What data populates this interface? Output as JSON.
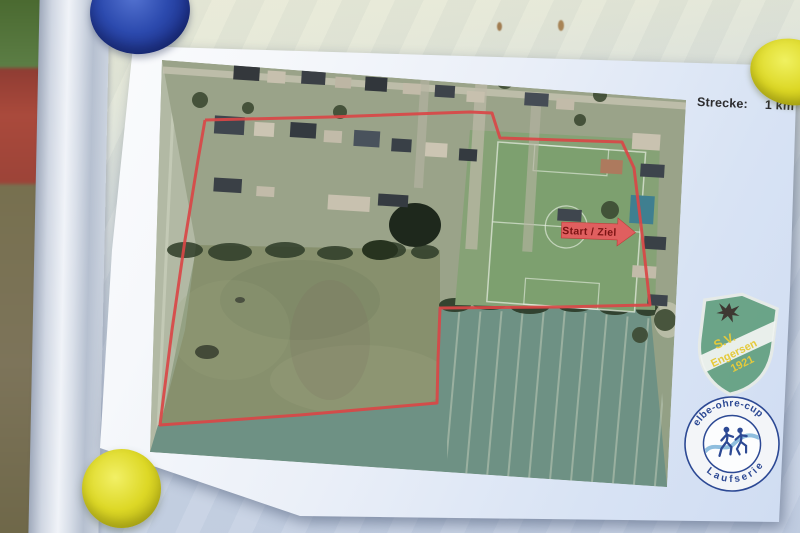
{
  "scene": {
    "distance_label": "Strecke:",
    "distance_value": "1 km",
    "start_finish_label": "Start / Ziel"
  },
  "logos": {
    "club_shield": {
      "abbr": "S.V.",
      "name": "Engersen",
      "year": "1921"
    },
    "cup_badge": {
      "arc_top": "elbe-ohre-cup",
      "arc_bottom": "Laufserie"
    }
  },
  "course": {
    "route_points": "205,120 330,117 470,112 492,113 500,138 560,140 622,142 634,168 641,225 650,305 560,307 440,308 438,360 437,403 300,415 160,425 172,330 185,240 198,160 205,120"
  },
  "colors": {
    "route": "#d94747",
    "arrow_fill": "#e05f5f",
    "arrow_text": "#7c1414",
    "magnet_blue": "#2b49ac",
    "magnet_yellow": "#d6d21c",
    "shield_green": "#63a080",
    "badge_navy": "#24418f"
  }
}
